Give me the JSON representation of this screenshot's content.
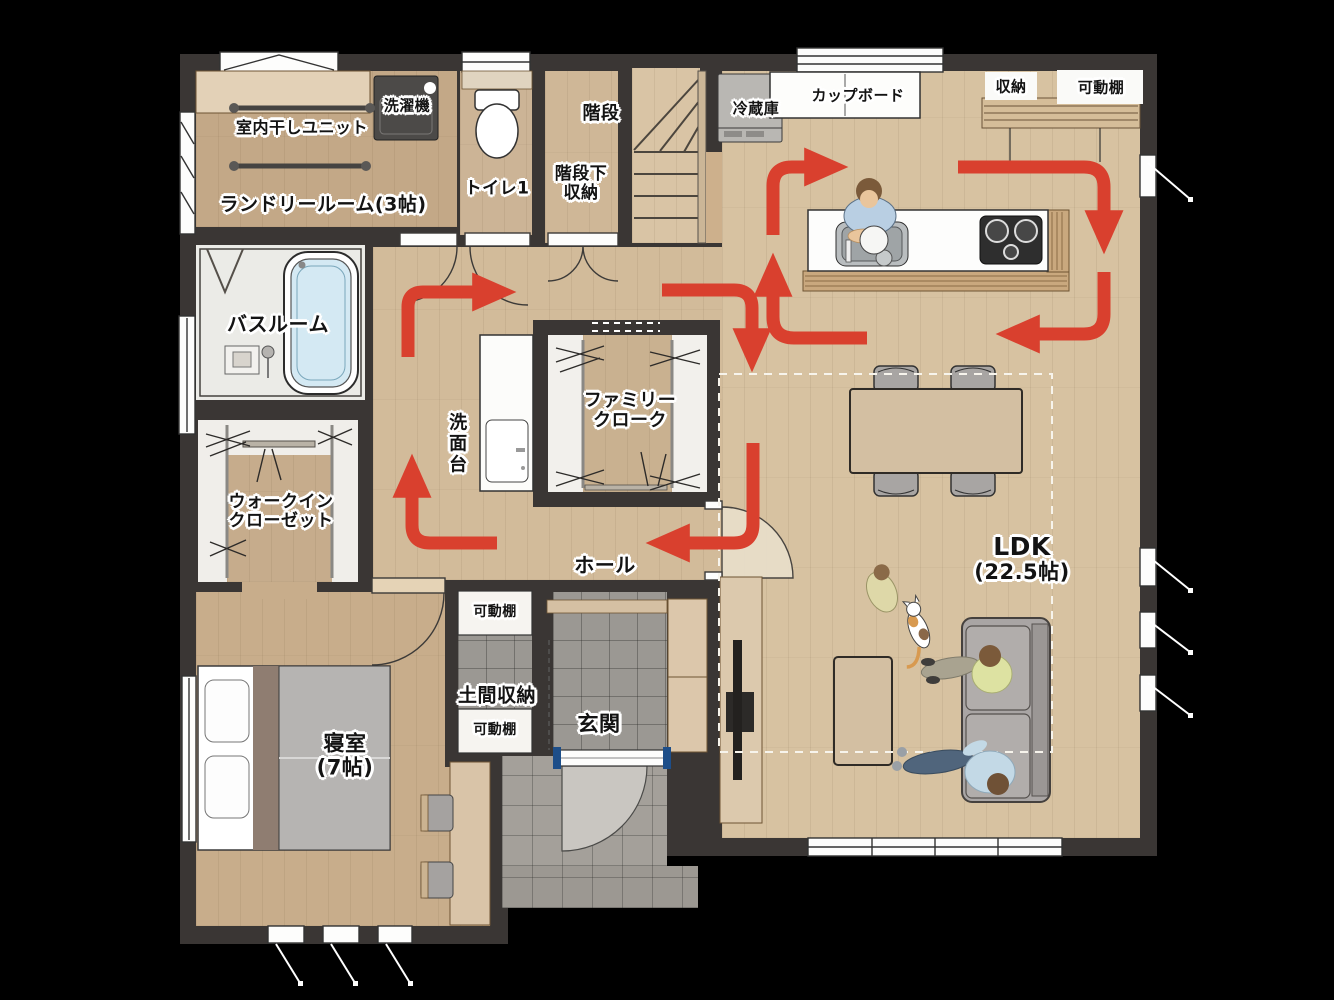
{
  "title": "1F間取り図（動線付き）",
  "colors": {
    "background": "#000000",
    "wall": "#3a3634",
    "floor_wood": "#cdb493",
    "floor_ldk": "#d7c2a1",
    "tile_gray": "#9b9893",
    "flow_arrow_red": "#d9402e",
    "bath_water_blue": "#d4e9f3",
    "furniture_tan": "#d9c4a8",
    "entrance_door_blue": "#1d4e89"
  },
  "labels": {
    "laundry_unit": "室内干しユニット",
    "washer": "洗濯機",
    "laundry_room": "ランドリールーム(3帖)",
    "toilet": "トイレ1",
    "under_stair": [
      "階段下",
      "収納"
    ],
    "stairs": "階段",
    "fridge": "冷蔵庫",
    "cupboard": "カップボード",
    "storage": "収納",
    "shelf_top_right": "可動棚",
    "bathroom": "バスルーム",
    "vanity": "洗面台",
    "family_cloak": [
      "ファミリー",
      "クローク"
    ],
    "wic": [
      "ウォークイン",
      "クローゼット"
    ],
    "hall": "ホール",
    "bedroom": [
      "寝室",
      "(7帖)"
    ],
    "doma_shelf_top": "可動棚",
    "doma": "土間収納",
    "doma_shelf_bottom": "可動棚",
    "genkan": "玄関",
    "ldk": [
      "LDK",
      "(22.5帖)"
    ]
  }
}
